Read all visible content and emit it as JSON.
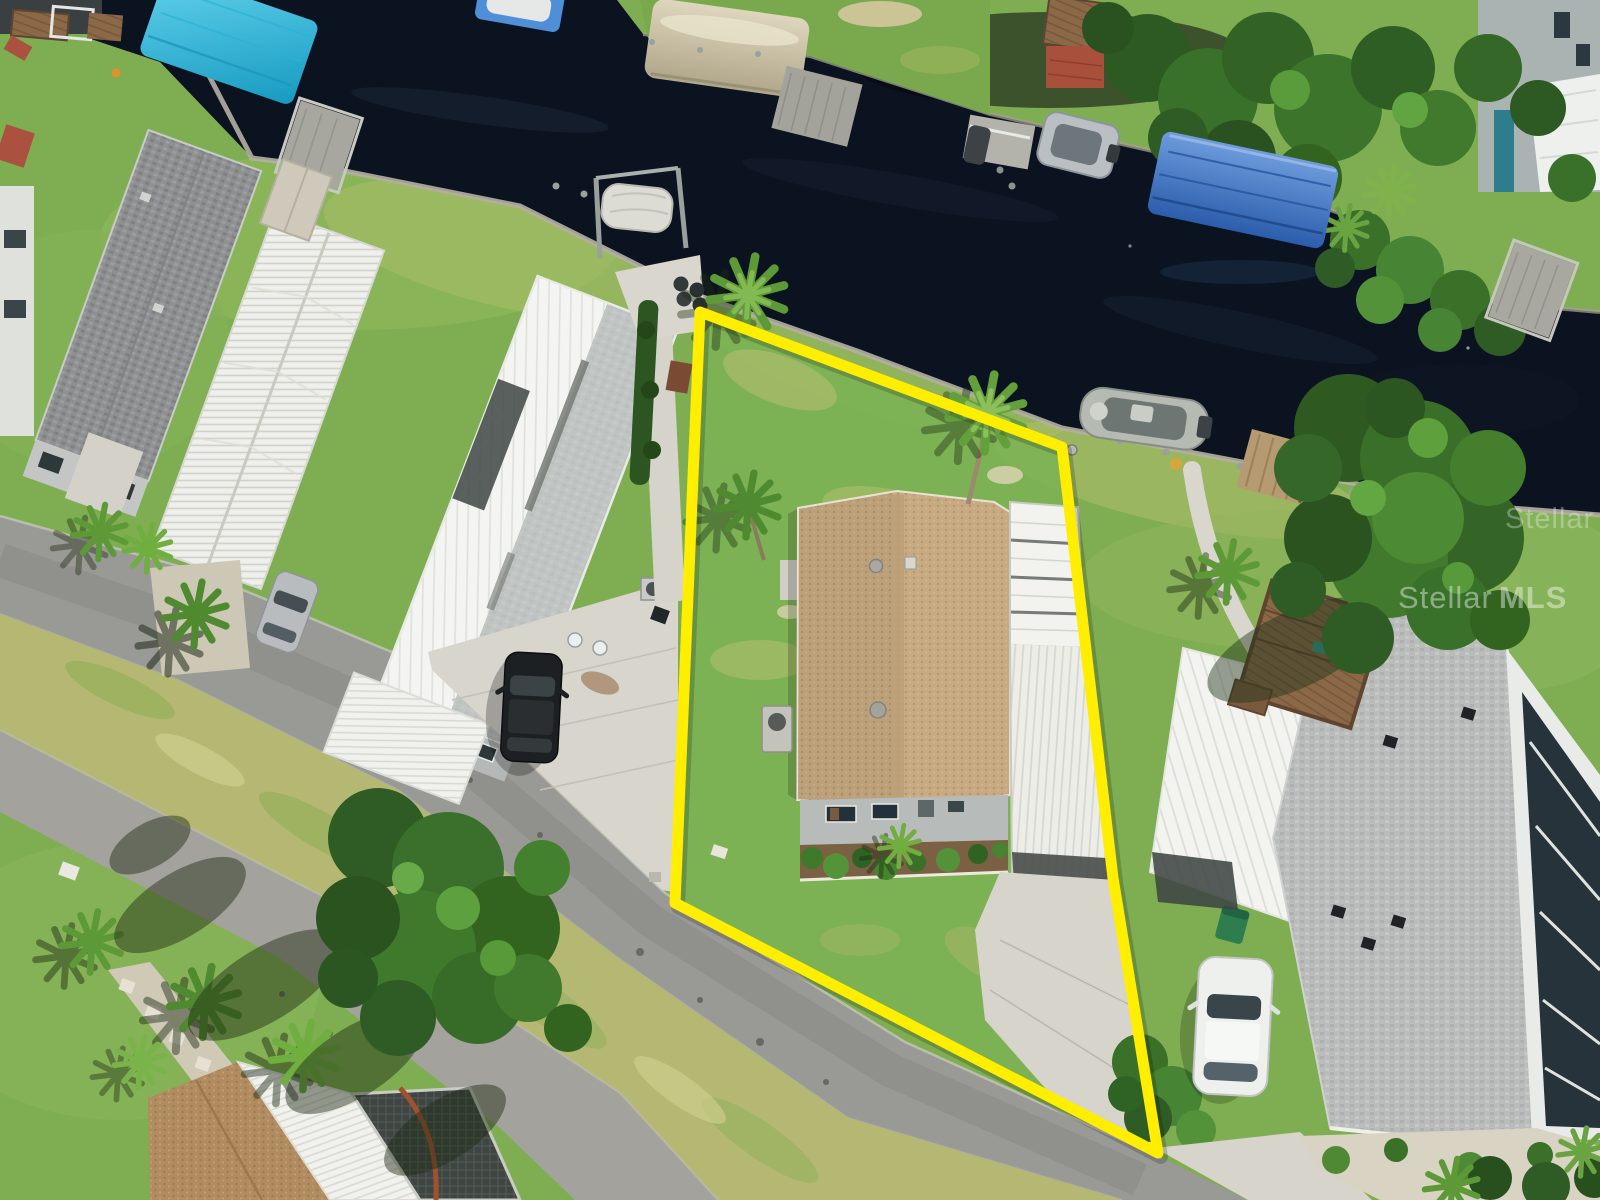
{
  "meta": {
    "type": "aerial-drone-photo",
    "width": 1600,
    "height": 1200,
    "description": "MLS listing drone photo of a waterfront mobile-home lot outlined with a yellow property boundary; dark canal across the top with docks and boat lifts, asphalt street at lower left, neighboring manufactured homes on both sides"
  },
  "watermark": {
    "brand": "Stellar",
    "suffix": "MLS",
    "color": "#ffffff",
    "opacity": "0.42"
  },
  "boundary": {
    "points": "700,312 1062,447 1113,878 1158,1153 675,903",
    "color": "#ffee00",
    "stroke_width": "11"
  },
  "palette": {
    "water": "#0b1220",
    "grass": "#7fae52",
    "grass_dry": "#b5b873",
    "road_asphalt": "#999995",
    "road_secondary": "#a3a29c",
    "concrete": "#d6d4cb",
    "roof_tan_shingle": "#c7aa82",
    "roof_white_metal": "#f3f3f0",
    "roof_gray_shingle": "#b9bcba",
    "roof_dark_shingle": "#8e9091",
    "canopy_blue": "#3f72c0",
    "canopy_teal": "#2fb7d9",
    "canopy_tan": "#cfc5aa",
    "deck_wood": "#8a6848",
    "tree_green": "#3a702b",
    "boundary_yellow": "#ffee00"
  },
  "features": [
    {
      "name": "canal",
      "label": "dark canal water"
    },
    {
      "name": "seawall",
      "label": "concrete seawall cap along canal"
    },
    {
      "name": "property-boundary",
      "label": "yellow lot outline"
    },
    {
      "name": "subject-lot-grass",
      "label": "grassy subject lot"
    },
    {
      "name": "subject-house-roof",
      "label": "tan shingle roof of subject home"
    },
    {
      "name": "subject-carport",
      "label": "white metal carport of subject home"
    },
    {
      "name": "subject-garden-bed",
      "label": "front shrub bed with edging"
    },
    {
      "name": "subject-driveway",
      "label": "concrete driveway of subject lot"
    },
    {
      "name": "center-console-boat",
      "label": "gray boat moored at lot seawall"
    },
    {
      "name": "wood-dock",
      "label": "wooden dock at lot corner"
    },
    {
      "name": "blue-canopy-boat-lift",
      "label": "blue canvas boat-lift canopy"
    },
    {
      "name": "teal-canopy-boat-lift",
      "label": "teal boat-lift canopy top left"
    },
    {
      "name": "tan-canopy-dock",
      "label": "tan arched dock canopy far bank"
    },
    {
      "name": "wrapped-boat-lift",
      "label": "shrink-wrapped boat on lift"
    },
    {
      "name": "far-dock-boat",
      "label": "boat and dock at canal junction"
    },
    {
      "name": "main-street",
      "label": "asphalt street lower left to bottom right"
    },
    {
      "name": "secondary-street",
      "label": "parallel smaller street bottom left"
    },
    {
      "name": "black-suv",
      "label": "black SUV on neighbor driveway"
    },
    {
      "name": "white-sedan",
      "label": "white sedan on right neighbor driveway"
    },
    {
      "name": "silver-car",
      "label": "silver car under left carport"
    },
    {
      "name": "left-house-dark-shingle",
      "label": "gray shingle roof home far left"
    },
    {
      "name": "left-house-corrugated",
      "label": "long corrugated metal roof home"
    },
    {
      "name": "left-house-white-metal",
      "label": "large white metal roof home left of lot"
    },
    {
      "name": "right-neighbor-house",
      "label": "right neighbor with white metal and gray shingle roofs"
    },
    {
      "name": "right-neighbor-sunroom",
      "label": "glass sunroom along right edge"
    },
    {
      "name": "wood-deck",
      "label": "brown wooden deck right neighbor"
    },
    {
      "name": "satellite-dish",
      "label": "satellite dish on right roof"
    },
    {
      "name": "bottom-left-houses",
      "label": "homes at bottom left corner"
    },
    {
      "name": "large-trees",
      "label": "large shade trees"
    },
    {
      "name": "palm-trees",
      "label": "cabbage palms and palmettos"
    }
  ]
}
